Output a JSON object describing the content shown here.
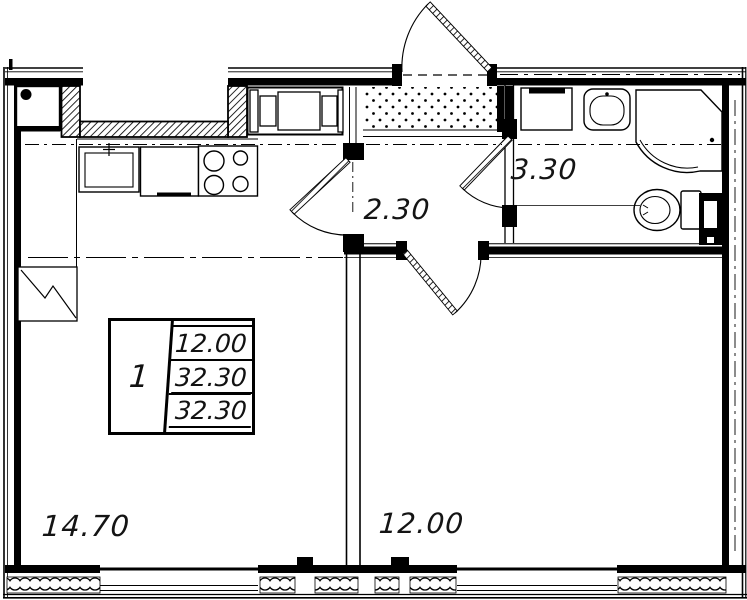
{
  "rooms": {
    "living": {
      "area": "14.70"
    },
    "bedroom": {
      "area": "12.00"
    },
    "hall": {
      "area": "2.30"
    },
    "bath": {
      "area": "3.30"
    }
  },
  "stamp": {
    "room_count": "1",
    "living_area": "12.00",
    "total_area": "32.30",
    "total_area_with_summer": "32.30"
  },
  "colors": {
    "line": "#000000",
    "background": "#ffffff"
  }
}
